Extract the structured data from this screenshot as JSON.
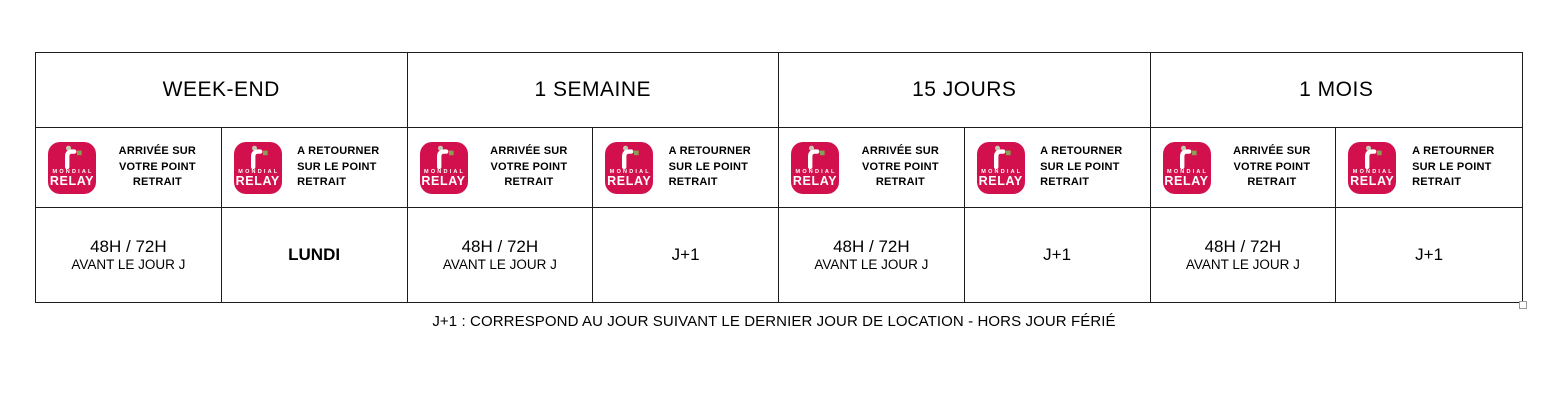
{
  "logo": {
    "word_top": "MONDIAL",
    "word_bottom": "relay",
    "colors": {
      "background": "#d3104e",
      "square": "#89a052",
      "dot": "#c3ccb2",
      "text": "#ffffff"
    }
  },
  "table": {
    "columns": [
      {
        "title": "WEEK-END",
        "pickup": {
          "label_lines": [
            "ARRIVÉE SUR",
            "VOTRE POINT RETRAIT"
          ],
          "value": "48H / 72H",
          "value_sub": "AVANT LE JOUR J"
        },
        "return": {
          "label_lines": [
            "A RETOURNER",
            "SUR LE POINT",
            "RETRAIT"
          ],
          "value": "LUNDI"
        }
      },
      {
        "title": "1 SEMAINE",
        "pickup": {
          "label_lines": [
            "ARRIVÉE SUR",
            "VOTRE POINT RETRAIT"
          ],
          "value": "48H / 72H",
          "value_sub": "AVANT LE JOUR J"
        },
        "return": {
          "label_lines": [
            "A RETOURNER",
            "SUR LE POINT",
            "RETRAIT"
          ],
          "value": "J+1"
        }
      },
      {
        "title": "15 JOURS",
        "pickup": {
          "label_lines": [
            "ARRIVÉE SUR",
            "VOTRE POINT RETRAIT"
          ],
          "value": "48H / 72H",
          "value_sub": "AVANT LE JOUR J"
        },
        "return": {
          "label_lines": [
            "A RETOURNER",
            "SUR LE POINT",
            "RETRAIT"
          ],
          "value": "J+1"
        }
      },
      {
        "title": "1 MOIS",
        "pickup": {
          "label_lines": [
            "ARRIVÉE SUR",
            "VOTRE POINT RETRAIT"
          ],
          "value": "48H / 72H",
          "value_sub": "AVANT LE JOUR J"
        },
        "return": {
          "label_lines": [
            "A RETOURNER",
            "SUR LE POINT",
            "RETRAIT"
          ],
          "value": "J+1"
        }
      }
    ],
    "footnote": "J+1 : CORRESPOND AU JOUR SUIVANT LE DERNIER JOUR DE LOCATION - HORS JOUR FÉRIÉ"
  }
}
